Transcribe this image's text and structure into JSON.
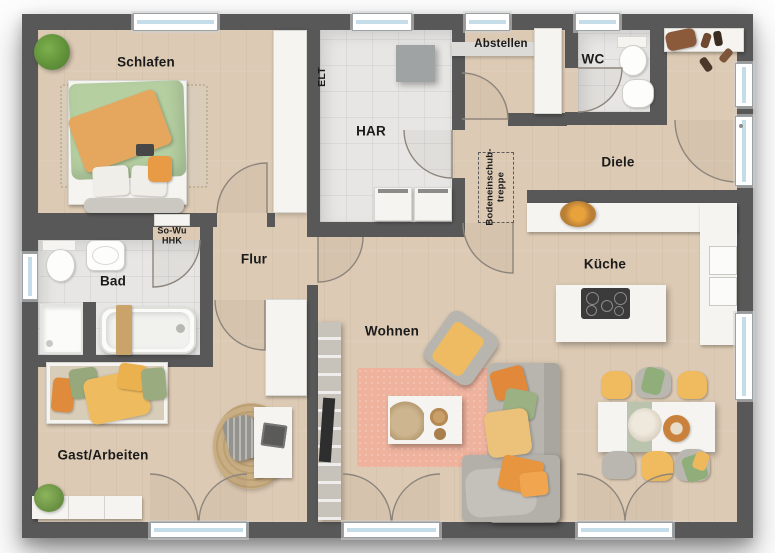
{
  "rooms": {
    "schlafen": "Schlafen",
    "har": "HAR",
    "abstellen": "Abstellen",
    "wc": "WC",
    "diele": "Diele",
    "bad": "Bad",
    "flur": "Flur",
    "kueche": "Küche",
    "wohnen": "Wohnen",
    "gast_arbeiten": "Gast/Arbeiten"
  },
  "annotations": {
    "heater_line1": "So-Wu",
    "heater_line2": "HHK",
    "attic_stairs_line1": "Bodeneinschub-",
    "attic_stairs_line2": "treppe",
    "electrical": "ELT"
  },
  "colors": {
    "wall": "#585858",
    "wood_floor": "#dccab4",
    "tile_floor": "#e7e6e4",
    "window_glass": "#c5dde9",
    "door_arc": "#8d857b",
    "rug_living": "#eeb29d",
    "rug_jute": "#c9ad83",
    "duvet_green": "#b5cfa1",
    "blanket_orange": "#e5a75e",
    "chair_yellow": "#f0ba5e",
    "sofa_gray": "#b8b5af",
    "text": "#1b1b1b",
    "furniture_white": "#f5f4f1"
  }
}
